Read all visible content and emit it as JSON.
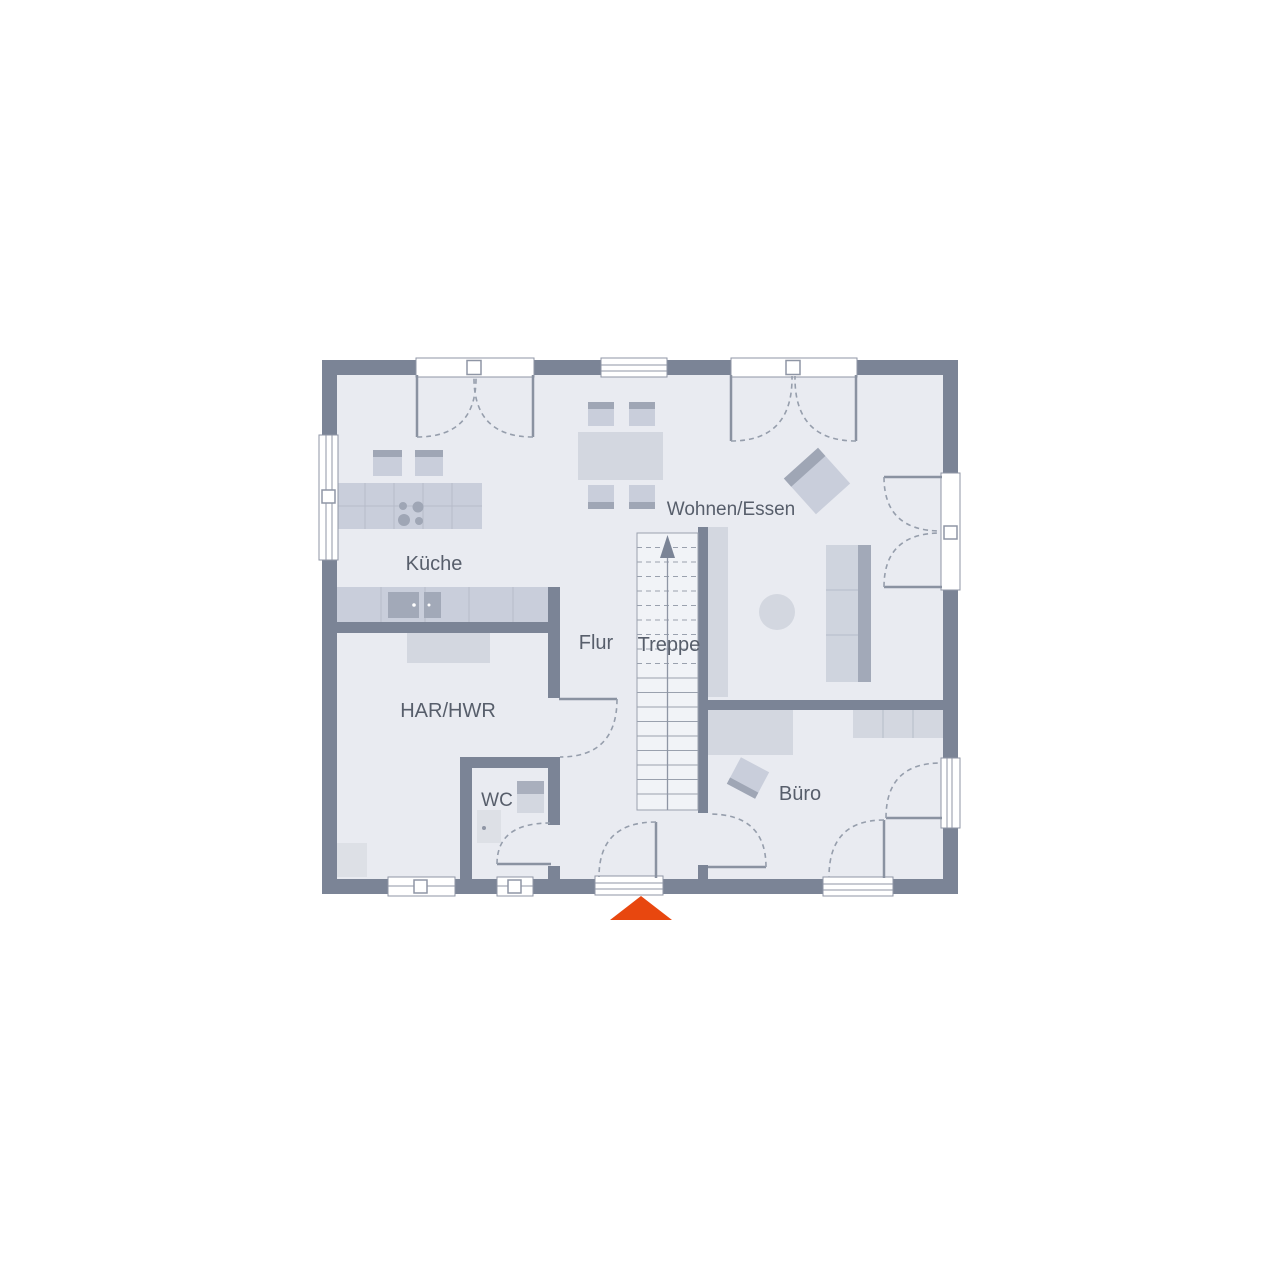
{
  "plan": {
    "type": "floor-plan",
    "rooms": {
      "kueche": {
        "label": "Küche"
      },
      "wohnen_essen": {
        "label": "Wohnen/Essen"
      },
      "flur": {
        "label": "Flur"
      },
      "treppe": {
        "label": "Treppe"
      },
      "har_hwr": {
        "label": "HAR/HWR"
      },
      "wc": {
        "label": "WC"
      },
      "buero": {
        "label": "Büro"
      }
    },
    "entrance_marker": "triangle-up"
  },
  "colors": {
    "background": "#ffffff",
    "floor": "#e9ebf1",
    "wall": "#7b8496",
    "furn_light": "#d3d7e0",
    "furn_mid": "#c9cedb",
    "furn_dark": "#9fa6b5",
    "furn_dark2": "#a9afbd",
    "line": "#8f96a5",
    "grid": "#b6bcc9",
    "stair_fill": "#f1f3f7",
    "text": "#575e6b",
    "entrance": "#e8470f"
  }
}
